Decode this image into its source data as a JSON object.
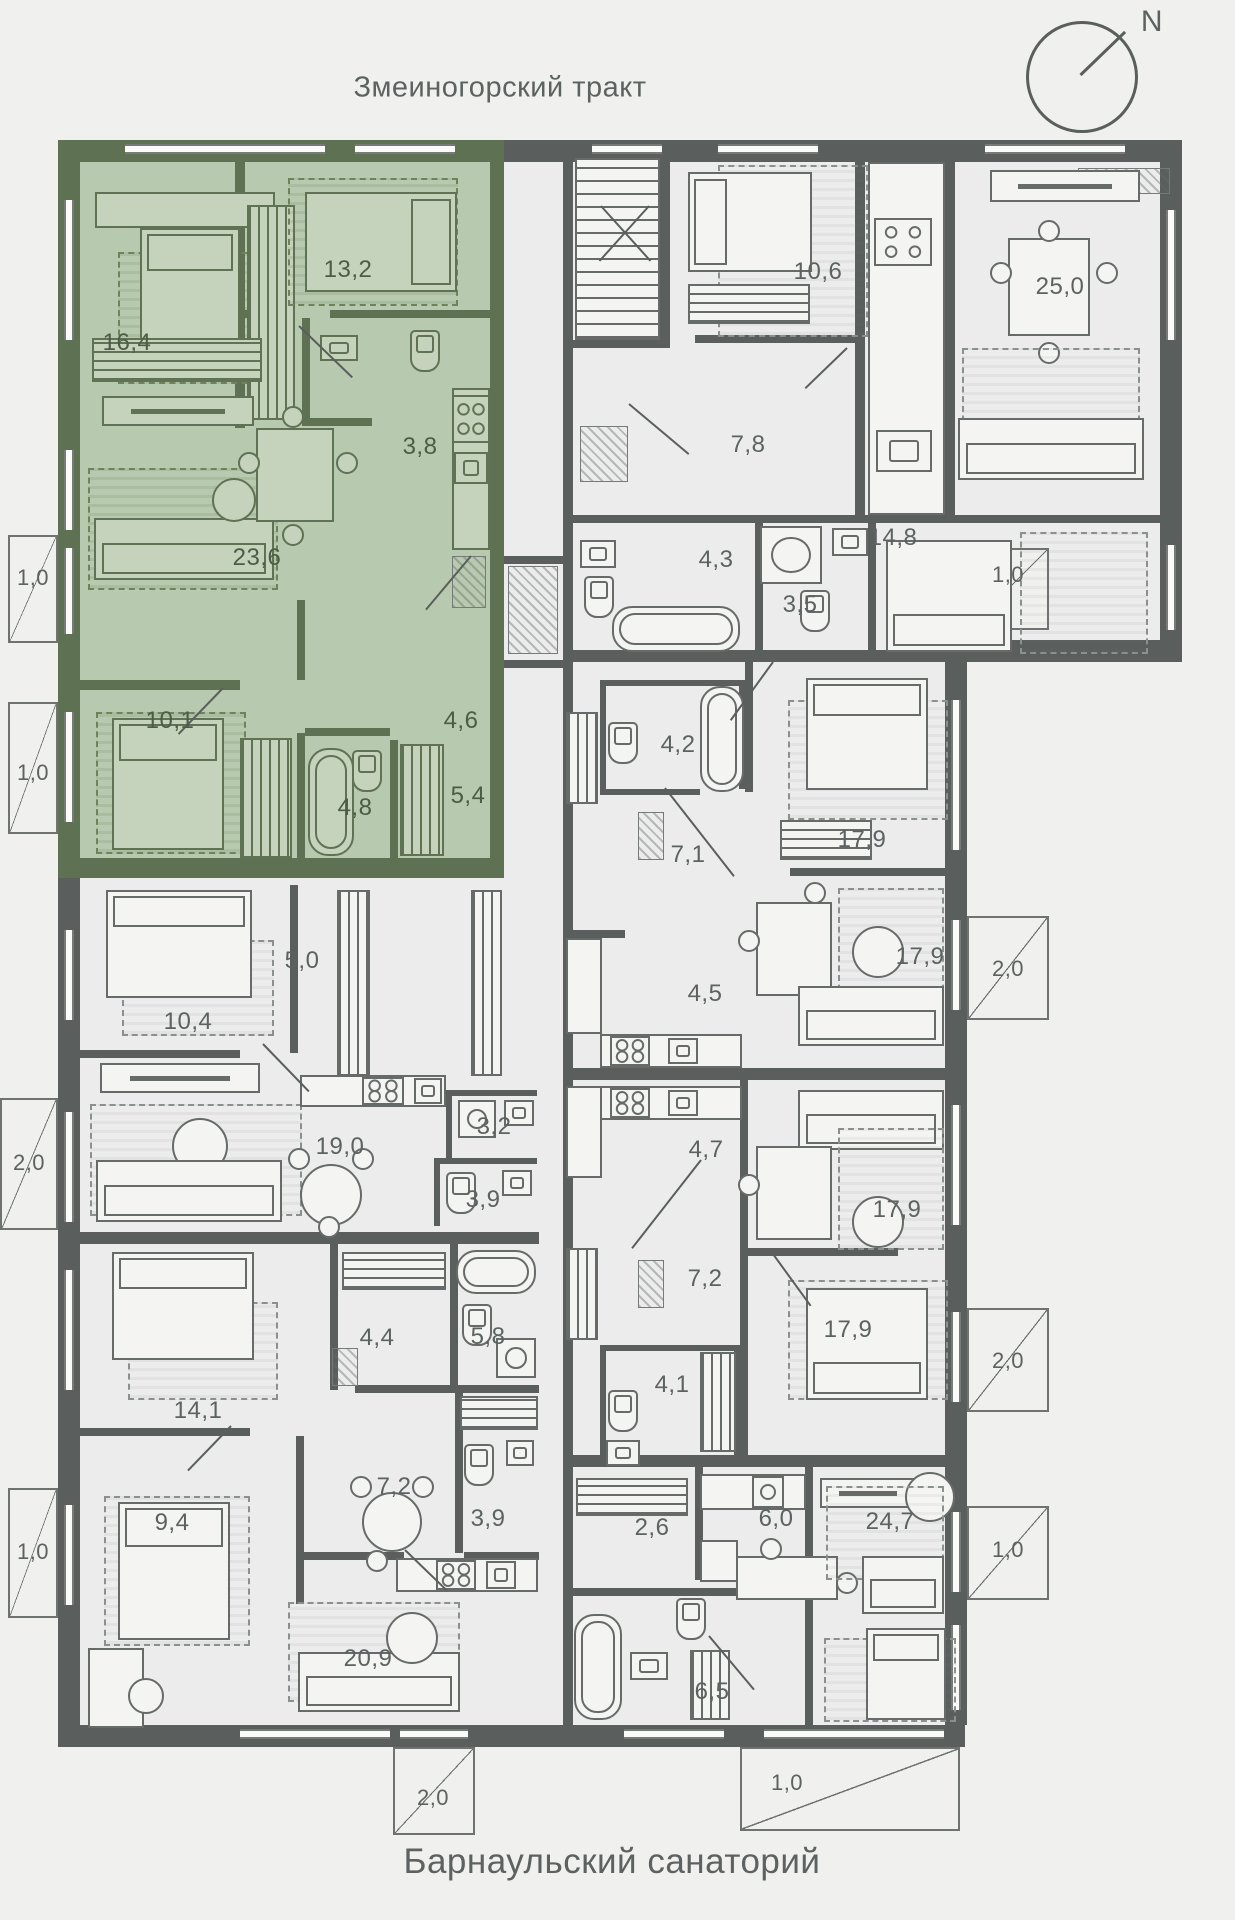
{
  "header": {
    "street": "Змеиногорский тракт"
  },
  "footer": {
    "place": "Барнаульский санаторий"
  },
  "compass": {
    "north": "N"
  },
  "colors": {
    "background": "#f0f0ef",
    "wall": "#5a5f5e",
    "highlight_wall": "#5e7152",
    "highlight_floor": "#b7c9ae",
    "floor": "#ececec",
    "label": "#5c6261",
    "highlight_label": "#4c5c46"
  },
  "apartments": {
    "green": {
      "bedroom_1": "16,4",
      "bedroom_2": "13,2",
      "bathroom_1": "3,8",
      "living": "23,6",
      "bedroom_3": "10,1",
      "hallway": "4,6",
      "bathroom_2": "4,8",
      "wardrobe": "5,4",
      "balcony_1": "1,0",
      "balcony_2": "1,0"
    },
    "left_mid": {
      "bedroom": "10,4",
      "hall": "5,0",
      "living": "19,0",
      "wc": "3,2",
      "bathroom": "3,9",
      "balcony": "2,0"
    },
    "left_low": {
      "bedroom_1": "14,1",
      "hall_1": "4,4",
      "bathroom_1": "5,8",
      "hall_2": "7,2",
      "bathroom_2": "3,9",
      "bedroom_2": "9,4",
      "living": "20,9",
      "balcony_left": "1,0",
      "balcony_bottom": "2,0"
    },
    "right_top": {
      "bedroom_1": "10,6",
      "living": "25,0",
      "hall": "7,8",
      "bathroom_1": "4,3",
      "bathroom_2": "3,5",
      "bedroom_2": "14,8",
      "balcony": "1,0"
    },
    "right_mid_1": {
      "bathroom": "4,2",
      "bedroom": "17,9",
      "hall": "7,1",
      "kitchen": "4,5",
      "living": "17,9",
      "balcony": "2,0"
    },
    "right_mid_2": {
      "kitchen": "4,7",
      "living": "17,9",
      "hall": "7,2",
      "bedroom": "17,9",
      "bathroom": "4,1",
      "balcony": "2,0"
    },
    "right_low": {
      "hall": "2,6",
      "kitchen": "6,0",
      "living": "24,7",
      "bathroom": "6,5",
      "balcony_right": "1,0",
      "balcony_bottom": "1,0"
    }
  }
}
